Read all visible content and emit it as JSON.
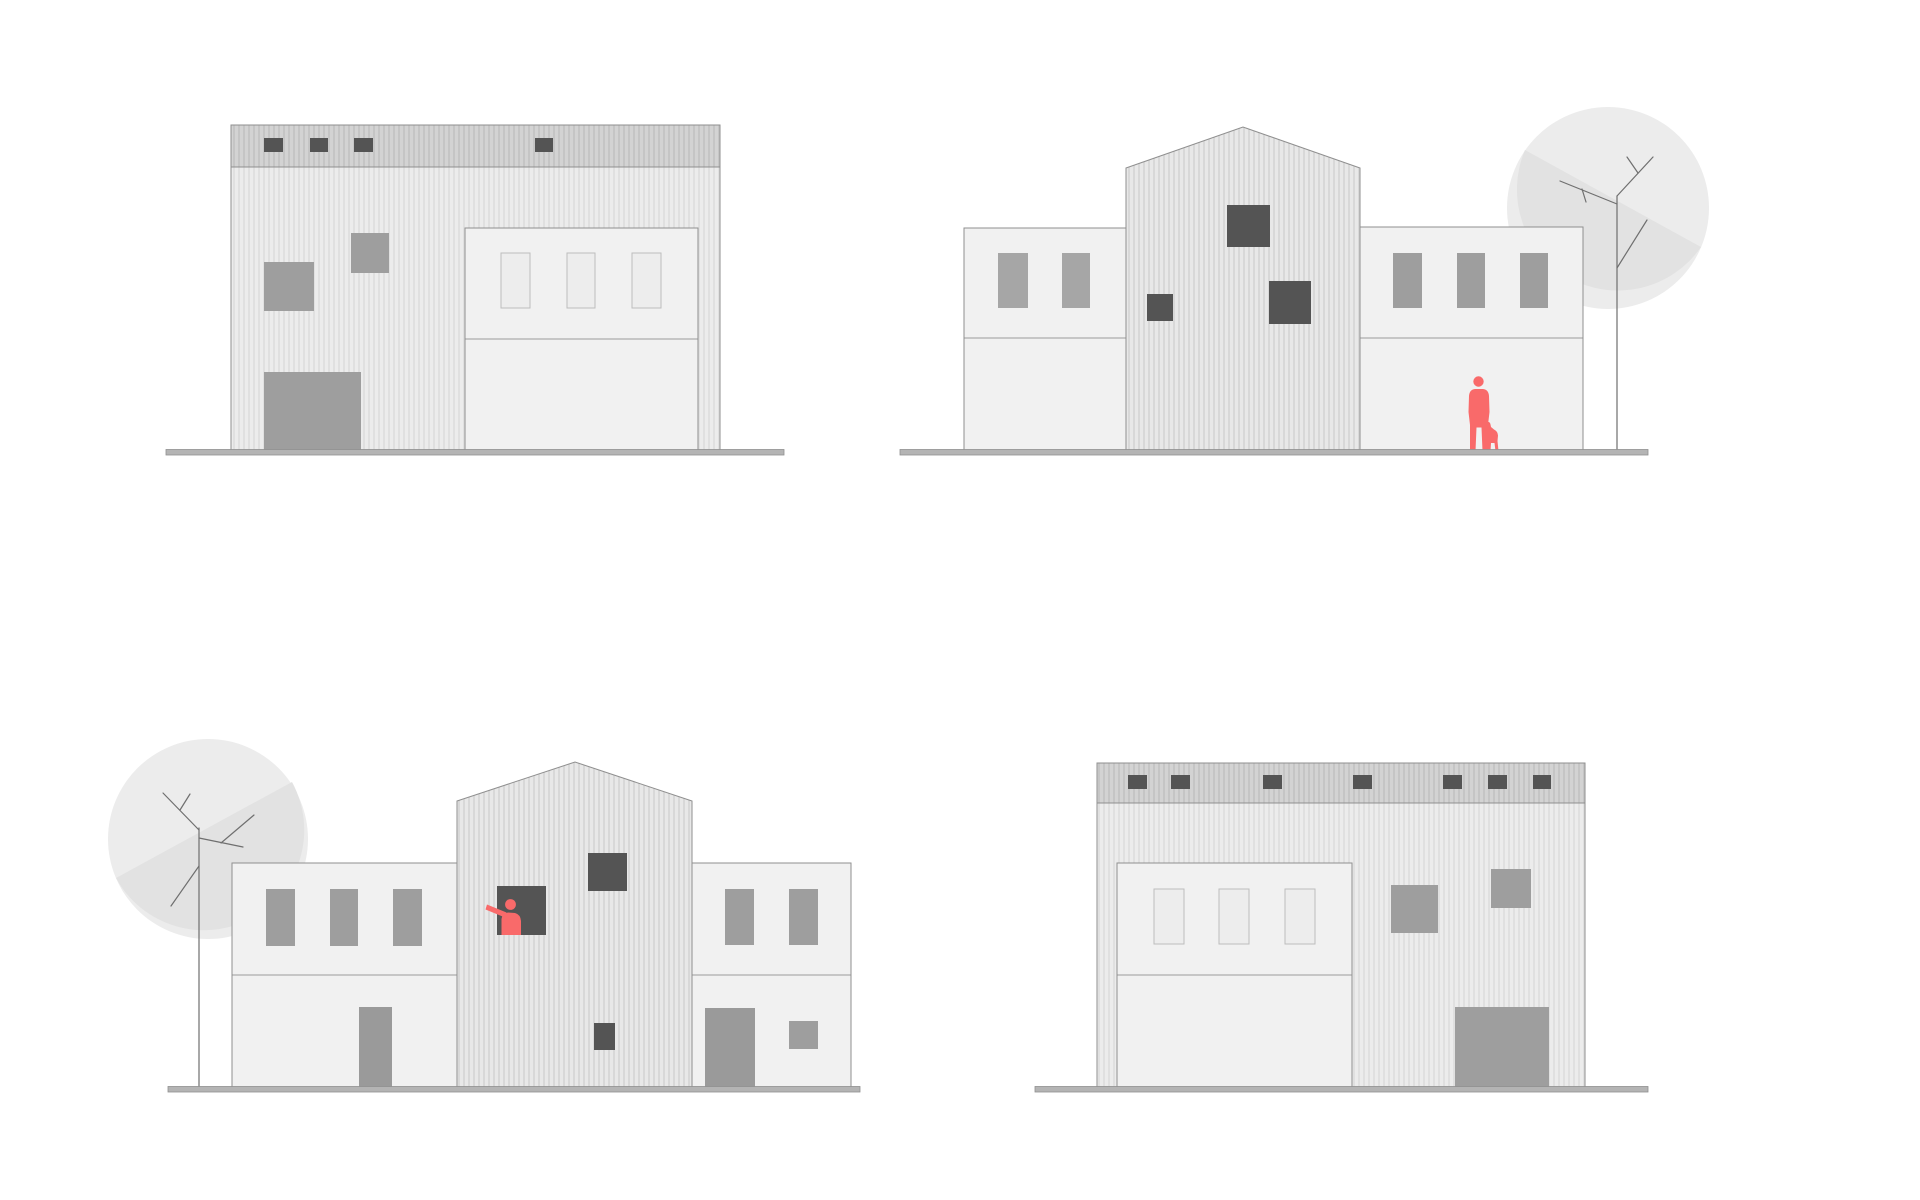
{
  "scene": {
    "title": "",
    "background": "#ffffff",
    "colors": {
      "background": "#ffffff",
      "outline": "#8f8f8f",
      "divider": "#9a9a9a",
      "corrugated_base": "#ececec",
      "corrugated_stripe": "#e0e0e0",
      "band_base": "#d3d3d3",
      "band_stripe": "#c5c5c5",
      "gable_base": "#e8e8e8",
      "gable_stripe": "#d8d8d8",
      "stucco": "#f1f1f1",
      "window_dark": "#545454",
      "window_medium": "#9e9e9e",
      "window_light": "#a6a6a6",
      "door_gray": "#9a9a9a",
      "panel_window_fill": "#ededed",
      "panel_window_border": "#bdbdbd",
      "ground_fill": "#b4b4b4",
      "ground_edge": "#909090",
      "canopy": "#ececec",
      "canopy_shade": "#e2e2e2",
      "branch": "#6f6f6f",
      "figure_red": "#f96a6a"
    },
    "figures": [
      {
        "id": "person-with-dog",
        "description": "red silhouette of adult with small dog",
        "location": "top-right elevation, at ground level"
      },
      {
        "id": "person-in-window",
        "description": "red silhouette leaning out of dark window, pointing left",
        "location": "bottom-left elevation, gable window"
      }
    ],
    "elevations": [
      {
        "id": "top-left",
        "kind": "warehouse-block",
        "features": [
          "clerestory-band",
          "4 dark band windows",
          "2 gray windows",
          "garage-door",
          "stucco-panel with 3 windows"
        ]
      },
      {
        "id": "top-right",
        "kind": "gabled-hall-with-wings",
        "features": [
          "2 windows left wing",
          "3 windows right wing",
          "3 dark gable windows",
          "tree",
          "person-with-dog"
        ]
      },
      {
        "id": "bottom-left",
        "kind": "gabled-hall-with-wings",
        "features": [
          "3 windows left wing",
          "2 windows right wing",
          "2 doors",
          "3 dark gable windows",
          "tree",
          "person-in-window"
        ]
      },
      {
        "id": "bottom-right",
        "kind": "warehouse-block",
        "features": [
          "clerestory-band",
          "7 dark band windows",
          "2 gray windows",
          "garage-door",
          "stucco-panel with 3 windows"
        ]
      }
    ]
  }
}
